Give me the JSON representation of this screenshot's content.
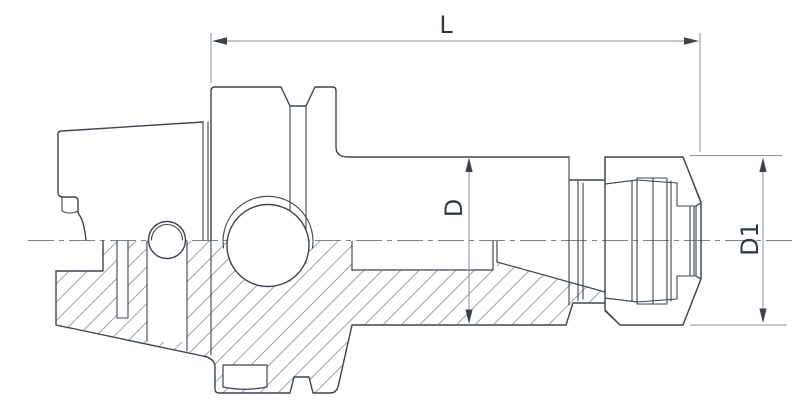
{
  "drawing": {
    "kind": "technical-section-drawing",
    "subject": "HSK shank ER collet chuck tool holder, half section view"
  },
  "dimensions": {
    "length": {
      "label": "L"
    },
    "body_diameter": {
      "label": "D"
    },
    "nose_diameter": {
      "label": "D1"
    }
  },
  "palette": {
    "background": "#ffffff",
    "outline": "#3b4551",
    "hatch": "#9aa3ad",
    "dimension_line": "#8a929b",
    "dimension_text": "#2e3844",
    "centerline": "#79828e"
  }
}
